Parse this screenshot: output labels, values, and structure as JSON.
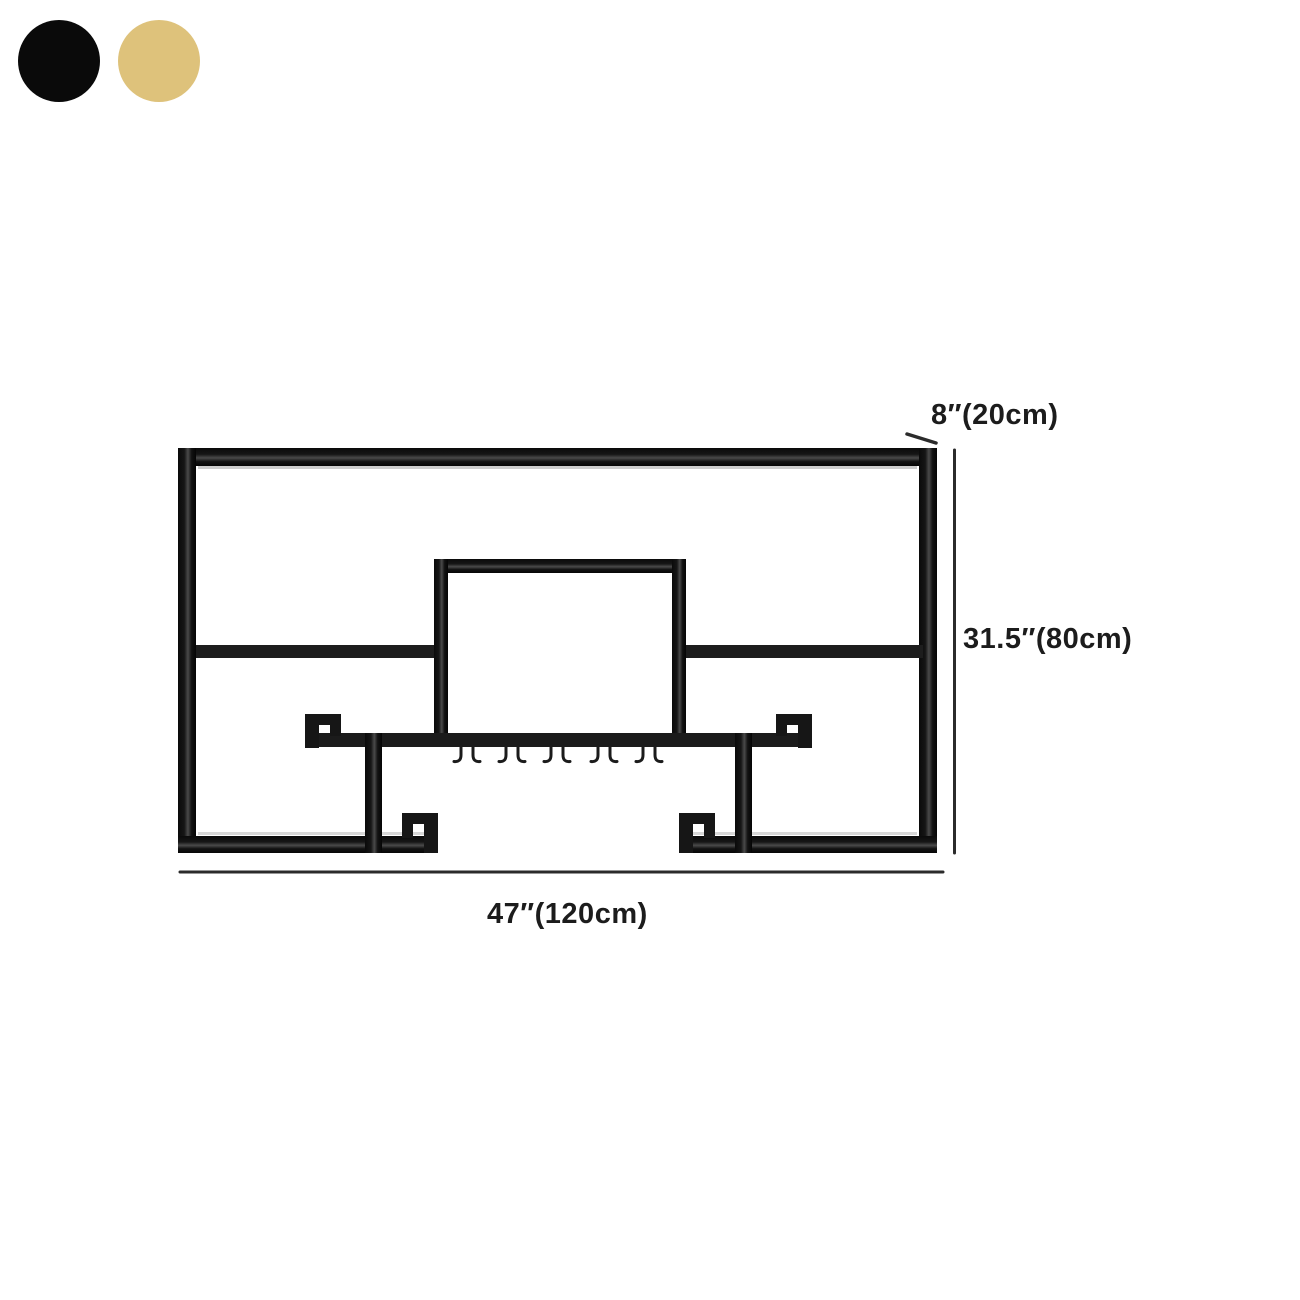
{
  "page": {
    "background": "#ffffff"
  },
  "color_swatches": {
    "items": [
      {
        "name": "black",
        "hex": "#0a0a0a"
      },
      {
        "name": "gold",
        "hex": "#dec27b"
      }
    ]
  },
  "diagram": {
    "kind": "product-dimension-line-drawing",
    "frame_color": "#1a1a1a",
    "dimension_line_color": "#2b2b2b",
    "hook_count": 10
  },
  "dims": {
    "depth": "8″(20cm)",
    "height": "31.5″(80cm)",
    "width": "47″(120cm)"
  }
}
